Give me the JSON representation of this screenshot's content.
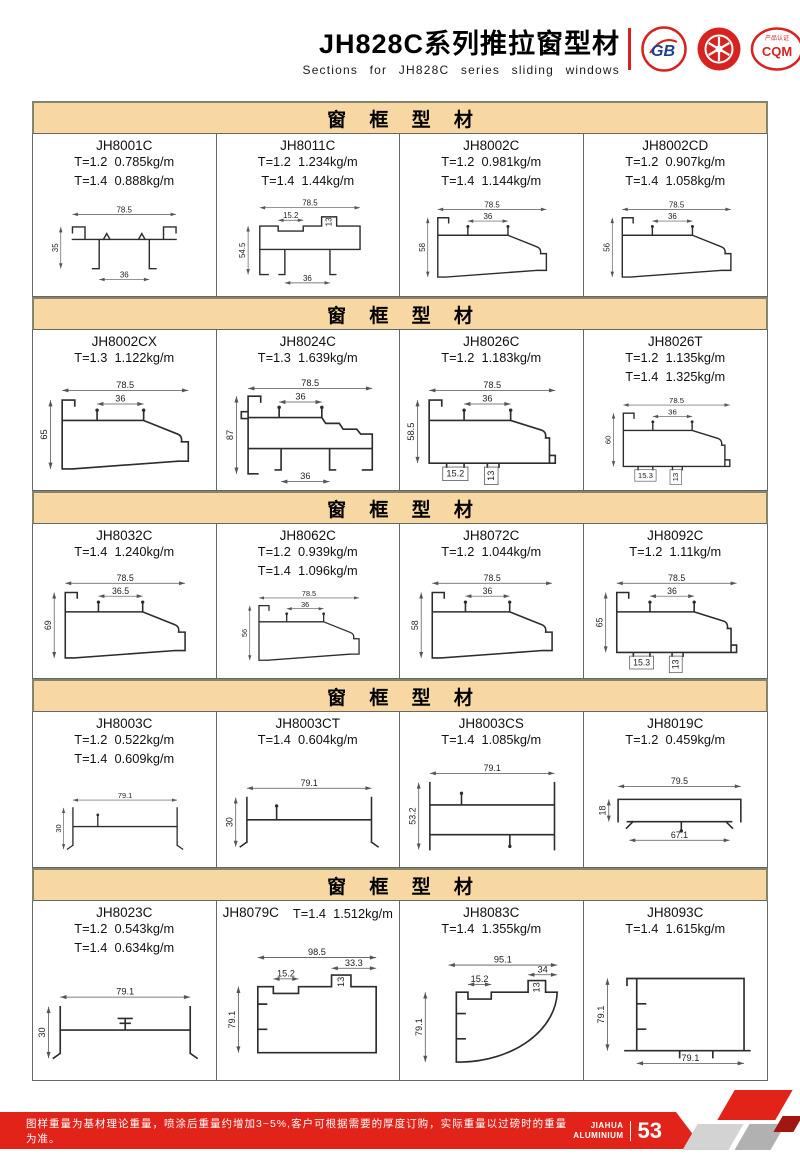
{
  "header": {
    "title": "JH828C系列推拉窗型材",
    "subtitle": "Sections for JH828C series sliding windows",
    "logos": [
      {
        "text": "GB"
      },
      {
        "text": ""
      },
      {
        "text": "CQM",
        "caption": "产品认证"
      }
    ]
  },
  "section_title": "窗 框 型 材",
  "sections": [
    {
      "cells": [
        {
          "code": "JH8001C",
          "weight1": "T=1.2  0.785kg/m",
          "weight2": "T=1.4  0.888kg/m",
          "dims": {
            "w": "78.5",
            "h": "35",
            "b": "36"
          }
        },
        {
          "code": "JH8011C",
          "weight1": "T=1.2  1.234kg/m",
          "weight2": "T=1.4  1.44kg/m",
          "dims": {
            "w": "78.5",
            "n1": "15.2",
            "n2": "13",
            "h": "54.5",
            "b": "36"
          }
        },
        {
          "code": "JH8002C",
          "weight1": "T=1.2  0.981kg/m",
          "weight2": "T=1.4  1.144kg/m",
          "dims": {
            "w": "78.5",
            "iw": "36",
            "h": "58"
          }
        },
        {
          "code": "JH8002CD",
          "weight1": "T=1.2  0.907kg/m",
          "weight2": "T=1.4  1.058kg/m",
          "dims": {
            "w": "78.5",
            "iw": "36",
            "h": "56"
          }
        }
      ]
    },
    {
      "cells": [
        {
          "code": "JH8002CX",
          "weight1": "T=1.3  1.122kg/m",
          "dims": {
            "w": "78.5",
            "iw": "36",
            "h": "65"
          }
        },
        {
          "code": "JH8024C",
          "weight1": "T=1.3  1.639kg/m",
          "dims": {
            "w": "78.5",
            "iw": "36",
            "h": "87",
            "b": "36"
          }
        },
        {
          "code": "JH8026C",
          "weight1": "T=1.2  1.183kg/m",
          "dims": {
            "w": "78.5",
            "iw": "36",
            "h": "58.5",
            "f1": "15.2",
            "f2": "13"
          }
        },
        {
          "code": "JH8026T",
          "weight1": "T=1.2  1.135kg/m",
          "weight2": "T=1.4  1.325kg/m",
          "dims": {
            "w": "78.5",
            "iw": "36",
            "h": "60",
            "f1": "15.3",
            "f2": "13"
          }
        }
      ]
    },
    {
      "cells": [
        {
          "code": "JH8032C",
          "weight1": "T=1.4  1.240kg/m",
          "dims": {
            "w": "78.5",
            "iw": "36.5",
            "h": "69"
          }
        },
        {
          "code": "JH8062C",
          "weight1": "T=1.2  0.939kg/m",
          "weight2": "T=1.4  1.096kg/m",
          "dims": {
            "w": "78.5",
            "iw": "36",
            "h": "56"
          }
        },
        {
          "code": "JH8072C",
          "weight1": "T=1.2  1.044kg/m",
          "dims": {
            "w": "78.5",
            "iw": "36",
            "h": "58"
          }
        },
        {
          "code": "JH8092C",
          "weight1": "T=1.2  1.11kg/m",
          "dims": {
            "w": "78.5",
            "iw": "36",
            "h": "65",
            "f1": "15.3",
            "f2": "13"
          }
        }
      ]
    },
    {
      "cells": [
        {
          "code": "JH8003C",
          "weight1": "T=1.2  0.522kg/m",
          "weight2": "T=1.4  0.609kg/m",
          "dims": {
            "w": "79.1",
            "h": "30"
          }
        },
        {
          "code": "JH8003CT",
          "weight1": "T=1.4  0.604kg/m",
          "dims": {
            "w": "79.1",
            "h": "30"
          }
        },
        {
          "code": "JH8003CS",
          "weight1": "T=1.4  1.085kg/m",
          "dims": {
            "w": "79.1",
            "h": "53.2"
          }
        },
        {
          "code": "JH8019C",
          "weight1": "T=1.2  0.459kg/m",
          "dims": {
            "w": "79.5",
            "h": "18",
            "b": "67.1"
          }
        }
      ]
    },
    {
      "cells": [
        {
          "code": "JH8023C",
          "weight1": "T=1.2  0.543kg/m",
          "weight2": "T=1.4  0.634kg/m",
          "dims": {
            "w": "79.1",
            "h": "30"
          }
        },
        {
          "code": "JH8079C",
          "weight1": "T=1.4  1.512kg/m",
          "dims": {
            "w": "98.5",
            "n1": "15.2",
            "n2": "33.3",
            "n3": "13",
            "h": "79.1"
          }
        },
        {
          "code": "JH8083C",
          "weight1": "T=1.4  1.355kg/m",
          "dims": {
            "w": "95.1",
            "n1": "15.2",
            "n2": "34",
            "n3": "13",
            "h": "79.1"
          }
        },
        {
          "code": "JH8093C",
          "weight1": "T=1.4  1.615kg/m",
          "dims": {
            "h": "79.1",
            "b": "79.1"
          }
        }
      ]
    }
  ],
  "footer": {
    "note": "图样重量为基材理论重量，喷涂后重量约增加3~5%,客户可根据需要的厚度订购，实际重量以过磅时的重量为准。",
    "brand_top": "JIAHUA",
    "brand_bottom": "ALUMINIUM",
    "page_number": "53"
  },
  "colors": {
    "accent_red": "#E2231A",
    "band_tan": "#F8D8A2"
  }
}
